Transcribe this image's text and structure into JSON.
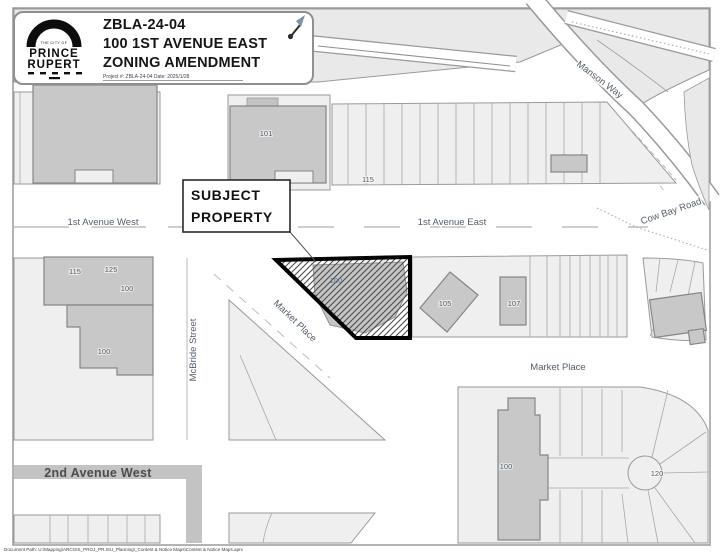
{
  "title_block": {
    "project_id": "ZBLA-24-04",
    "address_line": "100 1ST AVENUE EAST",
    "doc_type": "ZONING AMENDMENT",
    "meta_line": "Project #: ZBLA-24-04   Date: 2025/1/28",
    "logo": {
      "tagline": "THE CITY OF",
      "name_top": "PRINCE",
      "name_bottom": "RUPERT"
    }
  },
  "callout": {
    "line1": "SUBJECT",
    "line2": "PROPERTY"
  },
  "streets": {
    "manson_way": "Manson Way",
    "cow_bay_road": "Cow Bay Road",
    "first_ave_west": "1st Avenue West",
    "first_ave_east": "1st Avenue East",
    "mcbride_street": "McBride Street",
    "market_place_diag": "Market Place",
    "market_place_east": "Market Place",
    "second_ave_west": "2nd Avenue West"
  },
  "parcels": {
    "p101": "101",
    "p115_strip": "115",
    "p115_left": "115",
    "p125": "125",
    "p100_left_upper": "100",
    "p100_left_lower": "100",
    "p100_subject": "100",
    "p105": "105",
    "p107": "107",
    "p100_bottom": "100",
    "p120": "120"
  },
  "footer": {
    "document_path": "Document Path: U:\\Mapping\\ARCGIS_PROJ_PR.ISU_Planning\\_Contest & Notice Maps\\Contest & Notice Maps.aprx"
  },
  "colors": {
    "subject_outline": "#000000",
    "building_fill": "#c8c8c8",
    "block_fill": "#efefef",
    "terrain_fill": "#e9e9e9",
    "road_band_fill": "#c3c3c3",
    "street_label_color": "#535e6b",
    "parcel_label_color": "#4d5966"
  }
}
